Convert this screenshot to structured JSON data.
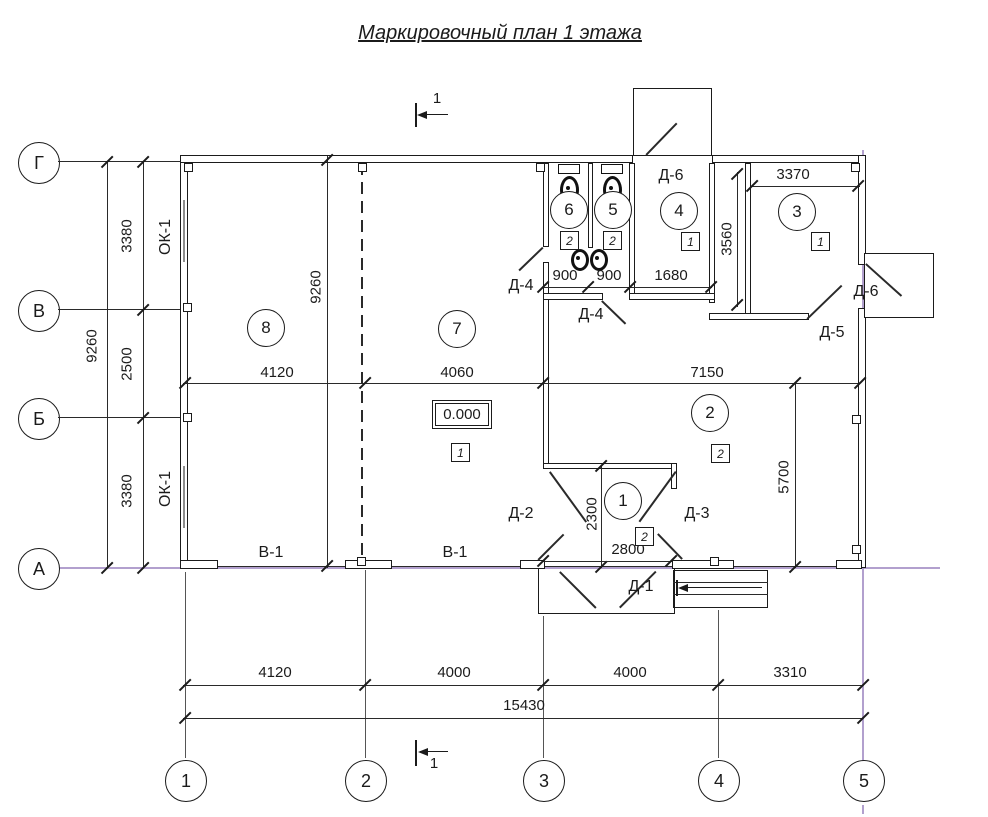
{
  "title": "Маркировочный план 1 этажа",
  "section": {
    "top": "1",
    "bottom": "1"
  },
  "axes": {
    "letters": [
      "Г",
      "В",
      "Б",
      "А"
    ],
    "numbers": [
      "1",
      "2",
      "3",
      "4",
      "5"
    ]
  },
  "rooms": {
    "c8": "8",
    "c7": "7",
    "c2": "2",
    "c1": "1",
    "c6": "6",
    "c5": "5",
    "c4": "4",
    "c3": "3",
    "s7": "1",
    "s2": "2",
    "s1": "2",
    "s6": "2",
    "s5": "2",
    "s4": "1",
    "s3": "1"
  },
  "doors": {
    "d1": "Д-1",
    "d2": "Д-2",
    "d3": "Д-3",
    "d4a": "Д-4",
    "d4b": "Д-4",
    "d5": "Д-5",
    "d6a": "Д-6",
    "d6b": "Д-6"
  },
  "windows": {
    "ok1a": "ОК-1",
    "ok1b": "ОК-1"
  },
  "gates": {
    "v1a": "В-1",
    "v1b": "В-1"
  },
  "elevation": "0.000",
  "dims": {
    "left_total": "9260",
    "left_g_v": "3380",
    "left_v_b": "2500",
    "left_b_a": "3380",
    "inner_height": "9260",
    "mid_1": "4120",
    "mid_2": "4060",
    "mid_3": "7150",
    "wc_1": "900",
    "wc_2": "900",
    "wc_3": "1680",
    "room3_w": "3370",
    "room3_h": "3560",
    "room2_h": "5700",
    "vest_h": "2300",
    "vest_w": "2800",
    "bot_1": "4120",
    "bot_2": "4000",
    "bot_3": "4000",
    "bot_4": "3310",
    "total": "15430"
  },
  "colors": {
    "line": "#1b1b1b",
    "axis_line": "#a58fc5"
  }
}
